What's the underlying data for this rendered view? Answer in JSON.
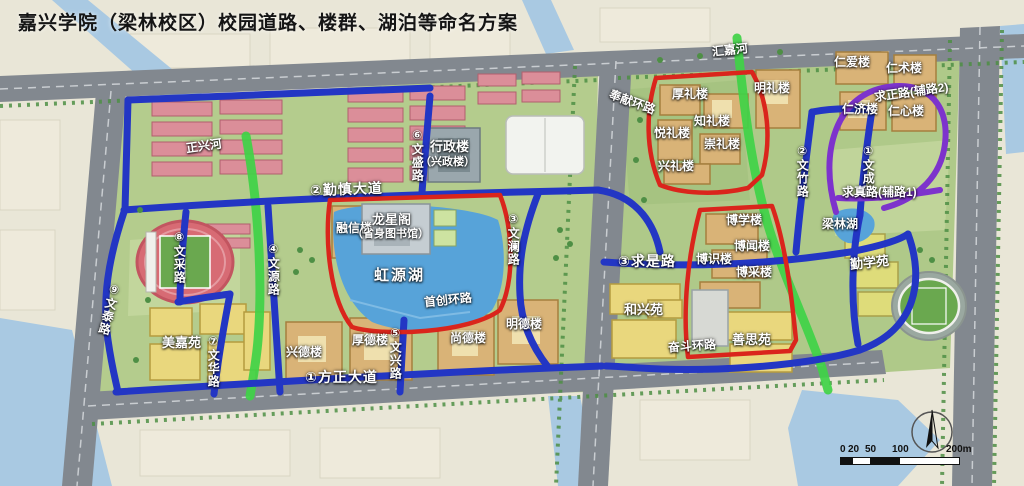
{
  "title": "嘉兴学院（梁林校区）校园道路、楼群、湖泊等命名方案",
  "colors": {
    "campus_green": "#b4cc8d",
    "water_blue": "#a9c9e2",
    "lake_blue": "#57a3d9",
    "city_road_gray": "#82888f",
    "campus_road_blue": "#2336c4",
    "river_green": "#3fd246",
    "ring_road_red": "#da251c",
    "aux_road_purple": "#7d33cc",
    "building_tan": "#d9b377",
    "dorm_yellow": "#e9d77d",
    "field_pink": "#db8e99"
  },
  "map": {
    "rivers": [
      "正兴河",
      "汇嘉河"
    ],
    "lakes": [
      "虹源湖",
      "梁林湖"
    ],
    "roads": {
      "avenues": [
        "①方正大道",
        "②勤慎大道",
        "③求是路"
      ],
      "wen": [
        "④文源路",
        "⑤文兴路",
        "⑥文盛路",
        "⑦文华路",
        "⑧文采路",
        "⑨文泰路",
        "②文竹路",
        "①文成路",
        "③文澜路"
      ],
      "rings": [
        "首创环路",
        "奉献环路",
        "奋斗环路"
      ],
      "aux": [
        "求正路(辅路2)",
        "求真路(辅路1)"
      ]
    },
    "buildings": {
      "library": [
        "龙星阁",
        "（省身图书馆）"
      ],
      "admin": [
        "行政楼",
        "（兴政楼）"
      ],
      "rongxin": "融信楼",
      "de": [
        "兴德楼",
        "厚德楼",
        "尚德楼",
        "明德楼"
      ],
      "li": [
        "厚礼楼",
        "悦礼楼",
        "知礼楼",
        "崇礼楼",
        "兴礼楼",
        "明礼楼"
      ],
      "ren": [
        "仁爱楼",
        "仁术楼",
        "仁济楼",
        "仁心楼"
      ],
      "bo": [
        "博学楼",
        "博闻楼",
        "博识楼",
        "博采楼"
      ],
      "dorms": [
        "美嘉苑",
        "和兴苑",
        "善思苑",
        "勤学苑"
      ]
    },
    "scalebar": [
      "0",
      "20",
      "50",
      "100",
      "200m"
    ]
  }
}
